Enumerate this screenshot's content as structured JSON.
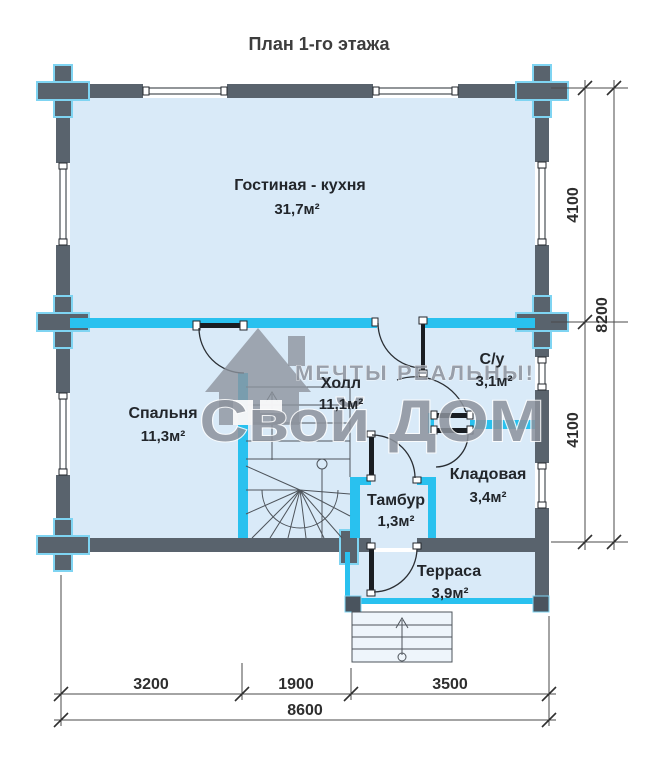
{
  "title": "План 1-го этажа",
  "rooms": {
    "living": {
      "name": "Гостиная - кухня",
      "area": "31,7м²"
    },
    "bedroom": {
      "name": "Спальня",
      "area": "11,3м²"
    },
    "hall": {
      "name": "Холл",
      "area": "11,1м²"
    },
    "bathroom": {
      "name": "С/у",
      "area": "3,1м²"
    },
    "storage": {
      "name": "Кладовая",
      "area": "3,4м²"
    },
    "vestibule": {
      "name": "Тамбур",
      "area": "1,3м²"
    },
    "terrace": {
      "name": "Терраса",
      "area": "3,9м²"
    }
  },
  "dimensions": {
    "right_top": "4100",
    "right_bottom": "4100",
    "right_total": "8200",
    "bottom_left": "3200",
    "bottom_middle": "1900",
    "bottom_right": "3500",
    "bottom_total": "8600"
  },
  "watermark": {
    "tagline": "МЕЧТЫ РЕАЛЬНЫ!",
    "brand": "Свой ДОМ"
  },
  "colors": {
    "outer_wall": "#59636d",
    "partition": "#29c1ef",
    "floor": "#d9eaf8",
    "label_text": "#22262b",
    "watermark": "#8d939d",
    "background": "#ffffff"
  }
}
